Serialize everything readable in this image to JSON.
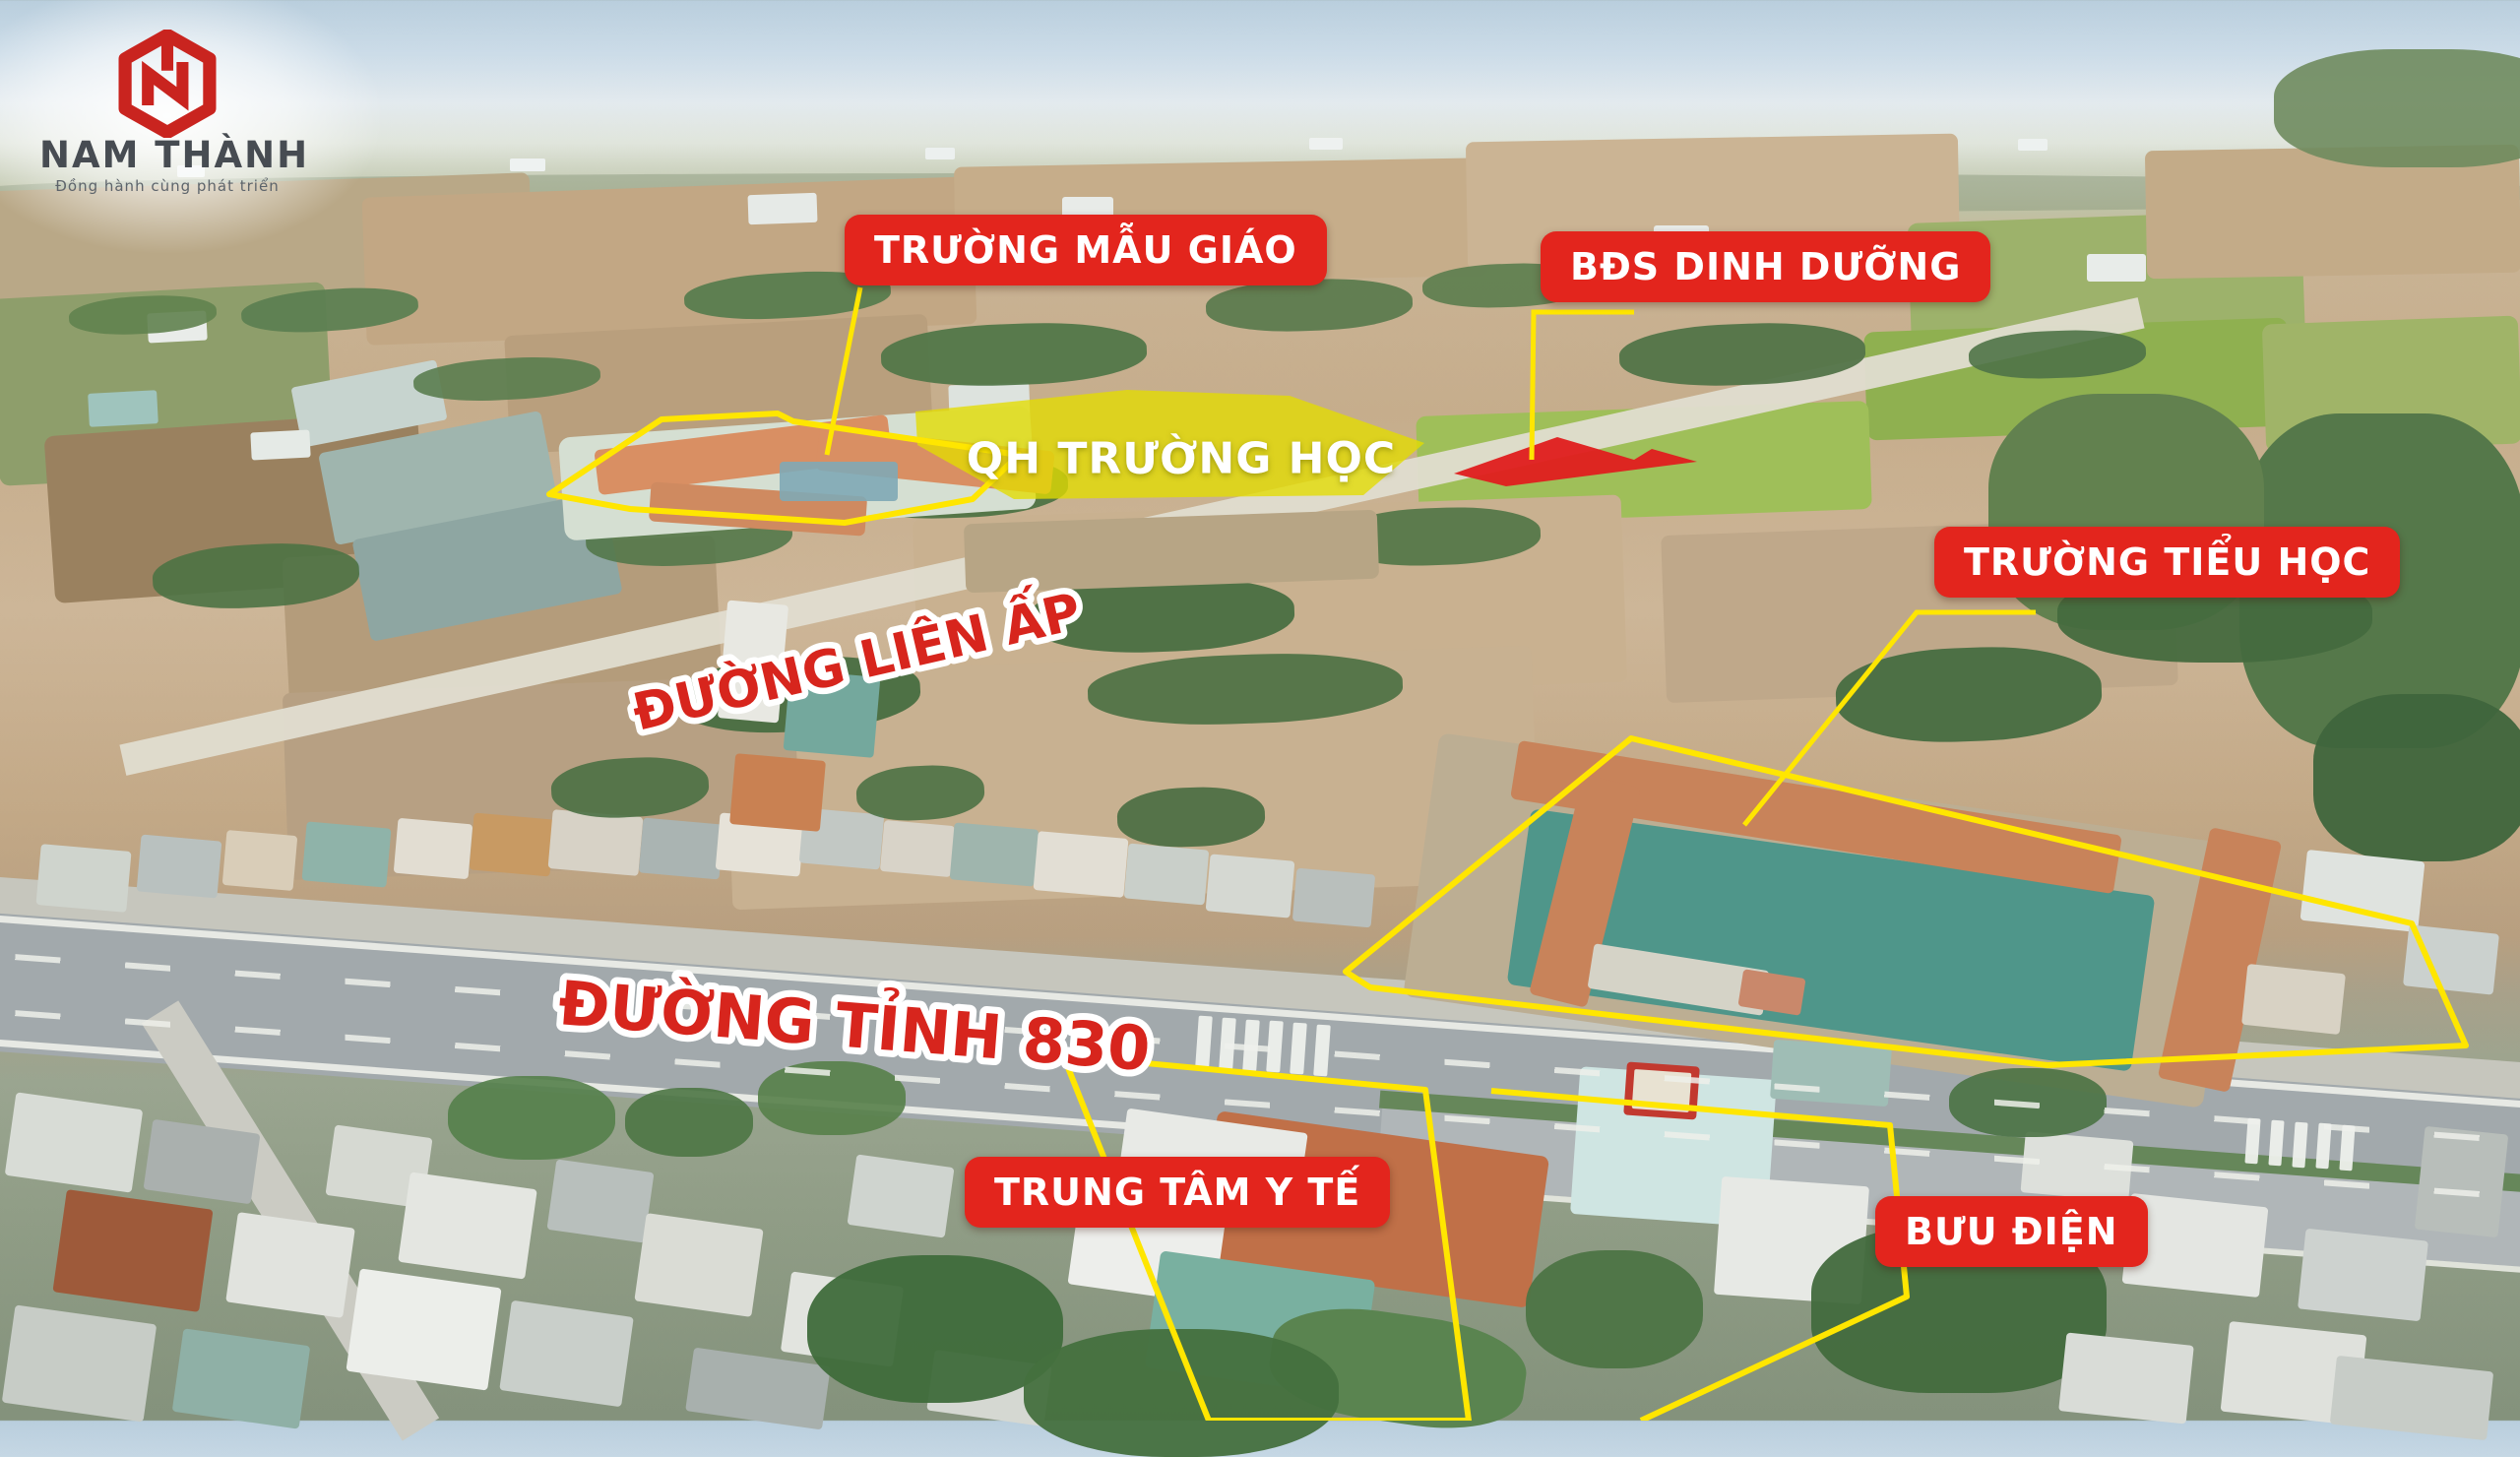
{
  "brand": {
    "name": "NAM THÀNH",
    "tagline": "Đồng hành cùng phát triển",
    "monogram": "NT"
  },
  "poi_labels": {
    "kindergarten": "TRƯỜNG MẪU GIÁO",
    "bds": "BĐS DINH DƯỠNG",
    "primary_school": "TRƯỜNG TIỂU HỌC",
    "medical_center": "TRUNG TÂM Y TẾ",
    "post_office": "BƯU ĐIỆN"
  },
  "area_labels": {
    "school_plan": "QH TRƯỜNG HỌC"
  },
  "road_labels": {
    "lien_ap": "ĐƯỜNG LIÊN ẤP",
    "dt830": "ĐƯỜNG TỈNH 830"
  },
  "colors": {
    "label_red": "#E3251D",
    "highlight_yellow": "#E3DC00",
    "outline_yellow": "#FFE600",
    "plot_red": "#E01F1F",
    "road_text_red": "#D7251D"
  }
}
